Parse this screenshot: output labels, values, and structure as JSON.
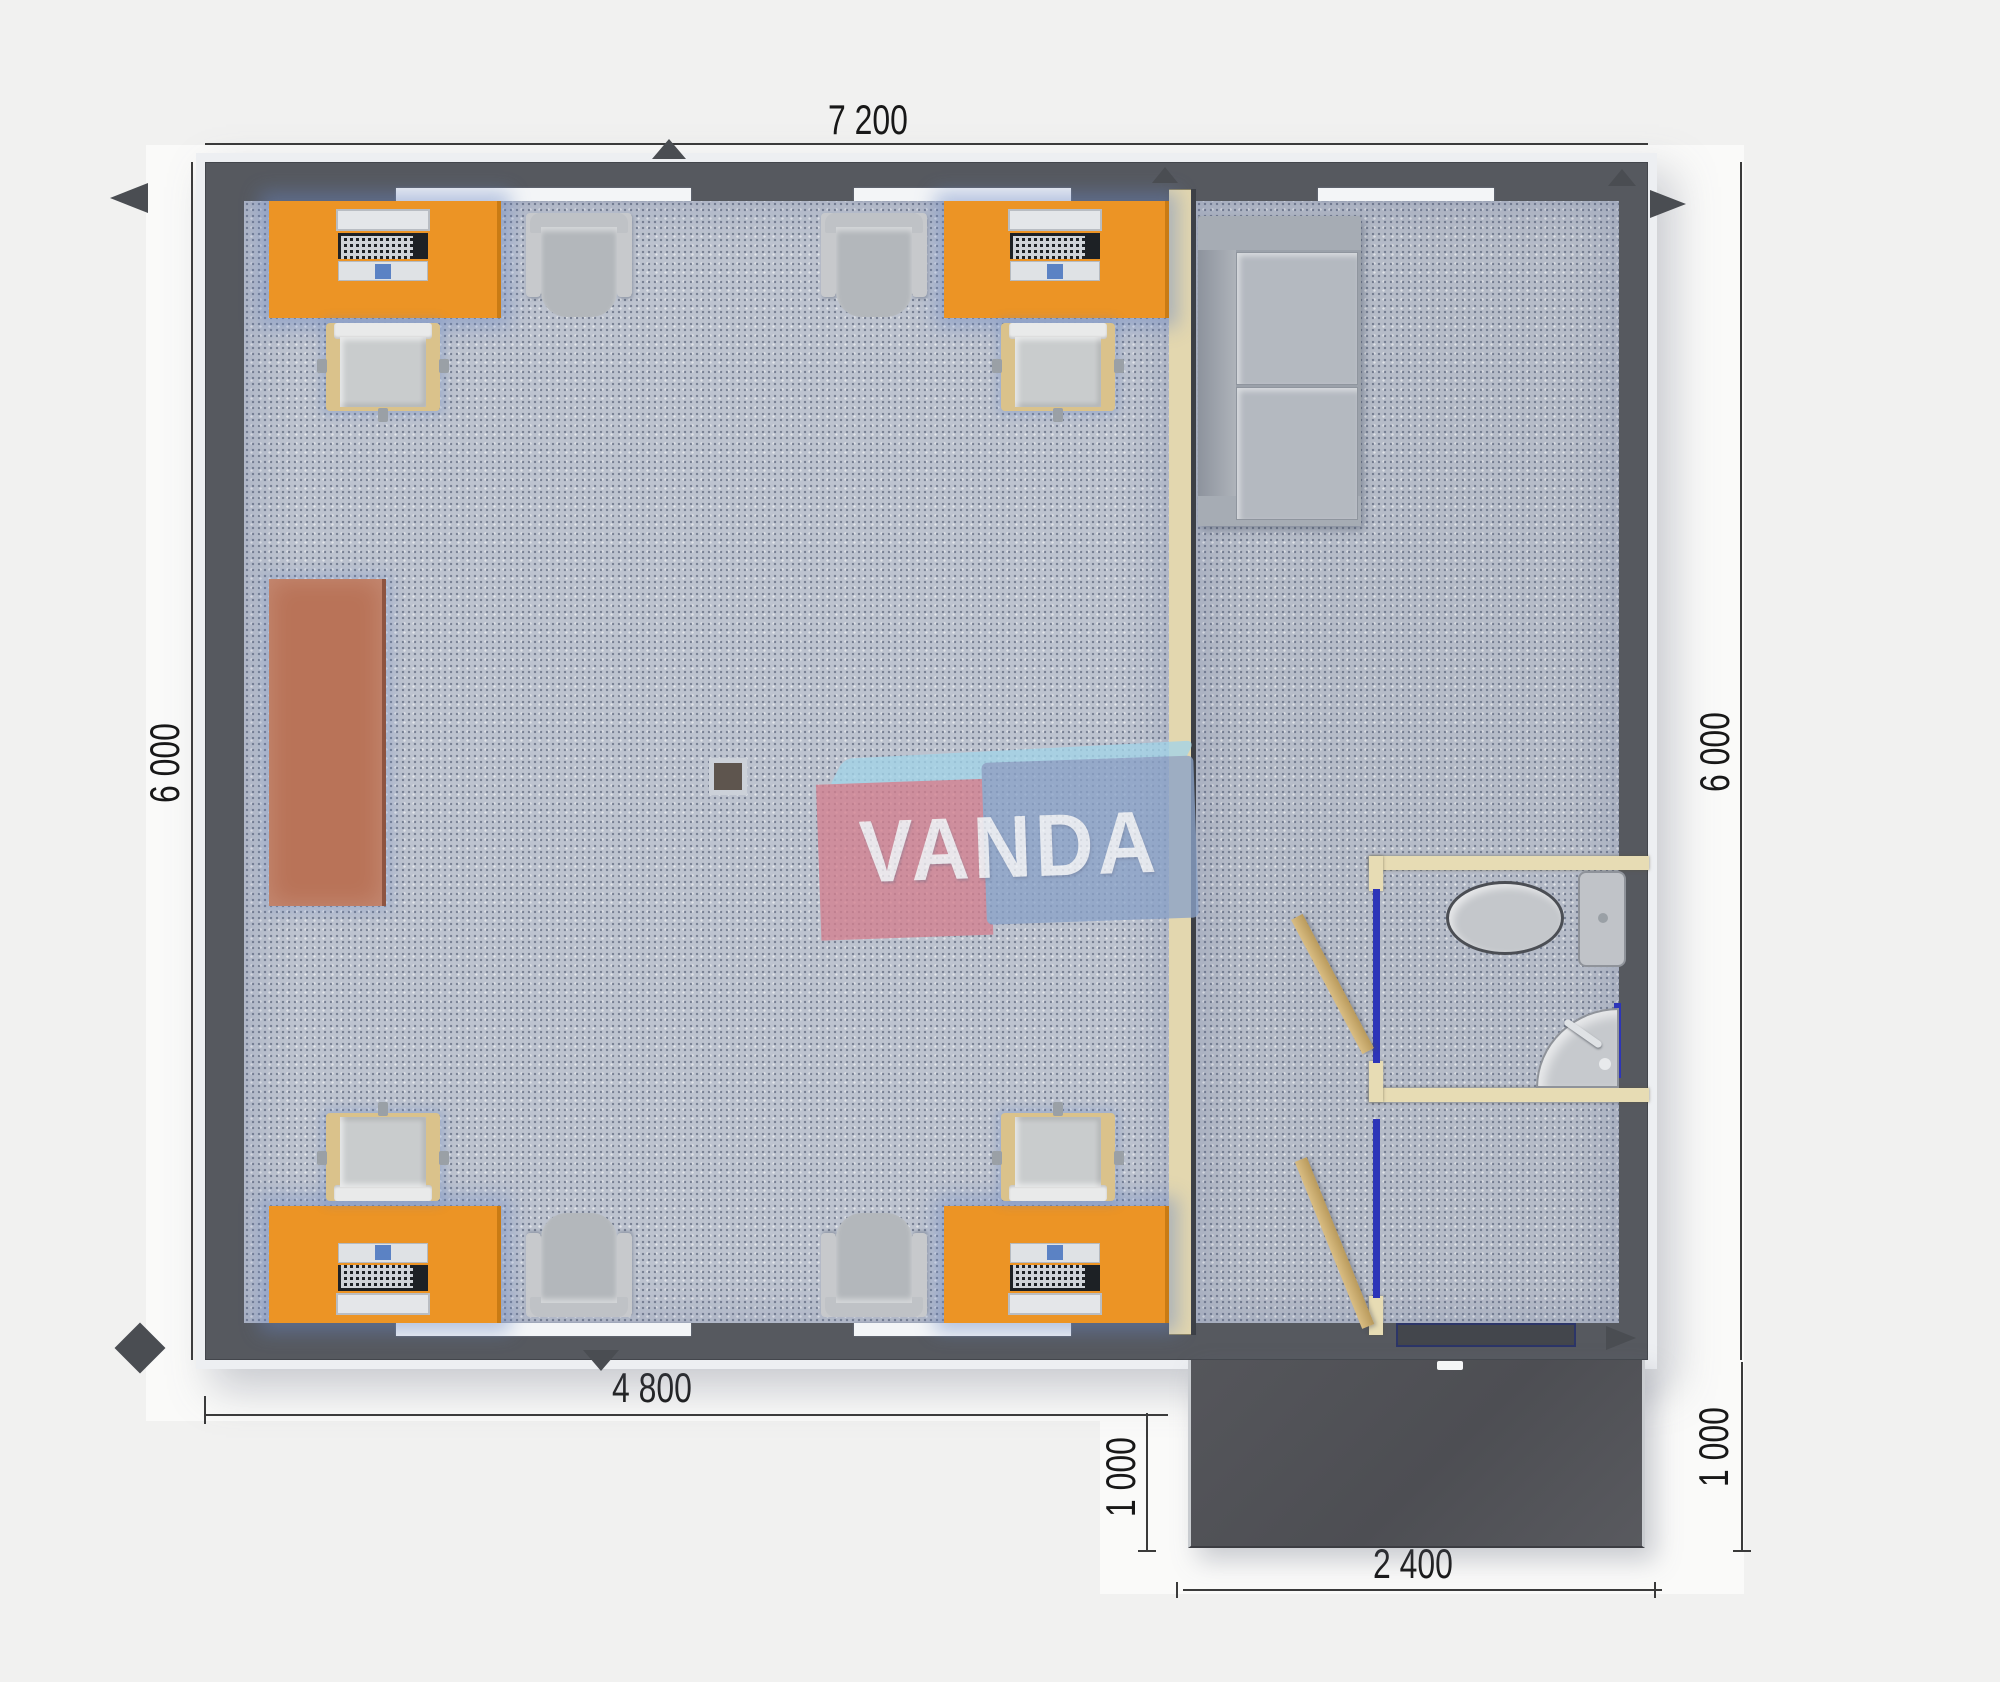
{
  "watermark": {
    "text": "VANDA"
  },
  "dimensions": {
    "width_top": "7 200",
    "height_left": "6 000",
    "height_right": "6 000",
    "office_width_bottom": "4 800",
    "porch_depth_left": "1 000",
    "porch_depth_right": "1 000",
    "porch_width_bottom": "2 400"
  },
  "rooms": {
    "left": "open office with four orange desks, chairs and cabinet",
    "right": "lounge with sofa, WC with toilet and sink, entrance hall with porch"
  },
  "furniture_counts": {
    "orange_desks": 4,
    "computers": 4,
    "desk_chairs": 4,
    "visitor_armchairs": 4,
    "sofa": 1,
    "brown_cabinet": 1,
    "toilet": 1,
    "corner_sink": 1,
    "interior_doors": 2,
    "entrance_porch": 1
  },
  "colors": {
    "background": "#f1f1f0",
    "wall_dark": "#56595f",
    "floor_speckle": "#bdc3cf",
    "desk_orange": "#ec9425",
    "cabinet_brown": "#b97358",
    "partition_tan": "#e3d7af",
    "door_trim_blue": "#2d35b8",
    "porch_dark": "#515257",
    "furniture_gray": "#b4b9c0",
    "watermark_red": "#d4808f",
    "watermark_blue": "#8aa2c8",
    "watermark_lightblue": "#a3d4e8",
    "dimension_text": "#181818"
  }
}
